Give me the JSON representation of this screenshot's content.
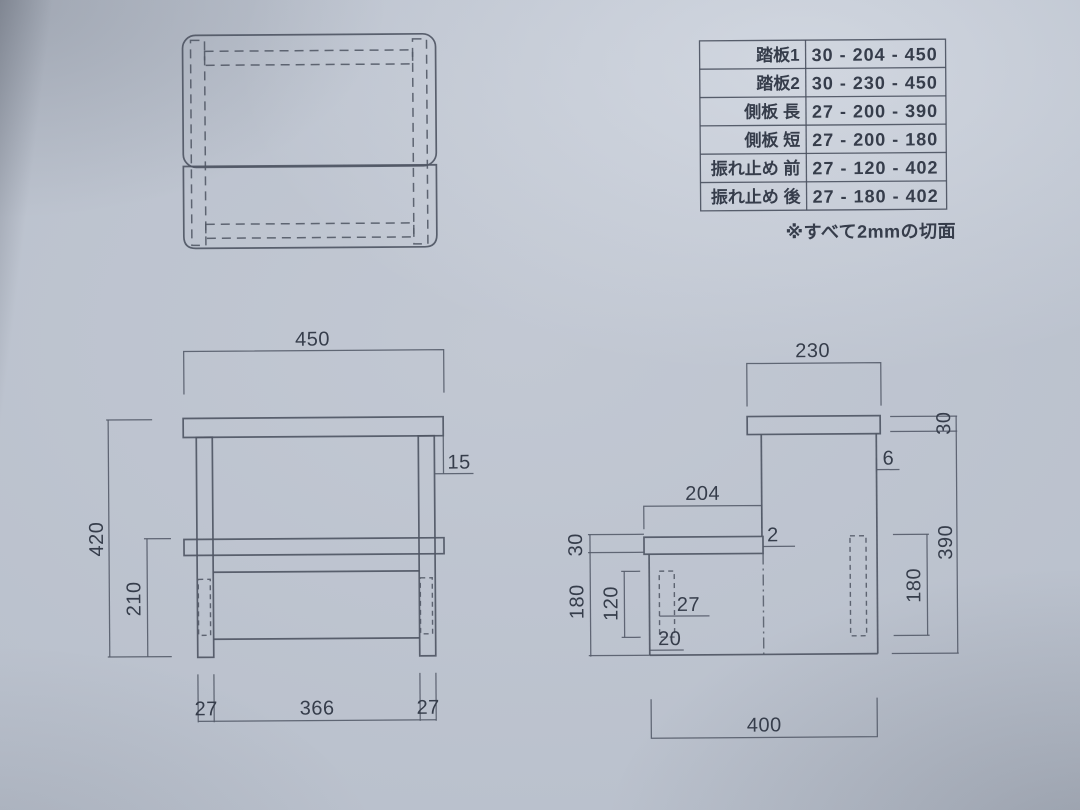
{
  "colors": {
    "paper": "#b9c0cc",
    "line": "#4f5664",
    "text": "#363d4b"
  },
  "parts_table": {
    "rows": [
      {
        "label": "踏板1",
        "value": "30 - 204 - 450"
      },
      {
        "label": "踏板2",
        "value": "30 - 230 - 450"
      },
      {
        "label": "側板 長",
        "value": "27 - 200 - 390"
      },
      {
        "label": "側板 短",
        "value": "27 - 200 - 180"
      },
      {
        "label": "振れ止め 前",
        "value": "27 - 120 - 402"
      },
      {
        "label": "振れ止め 後",
        "value": "27 - 180 - 402"
      }
    ],
    "note": "※すべて2mmの切面"
  },
  "front_view": {
    "dim_top_width": "450",
    "dim_total_height": "420",
    "dim_lower_height": "210",
    "dim_right_overhang": "15",
    "dim_left_leg": "27",
    "dim_inner_span": "366",
    "dim_right_leg": "27"
  },
  "side_view": {
    "dim_top_depth": "230",
    "dim_top_thickness": "30",
    "dim_rear_overhang": "6",
    "dim_side_panel_height": "390",
    "dim_rear_brace_height": "180",
    "dim_step_depth": "204",
    "dim_step_overhang": "2",
    "dim_step_thickness": "30",
    "dim_front_section_height": "180",
    "dim_front_brace_height": "120",
    "dim_front_brace_thickness": "27",
    "dim_front_inset": "20",
    "dim_total_depth": "400"
  }
}
